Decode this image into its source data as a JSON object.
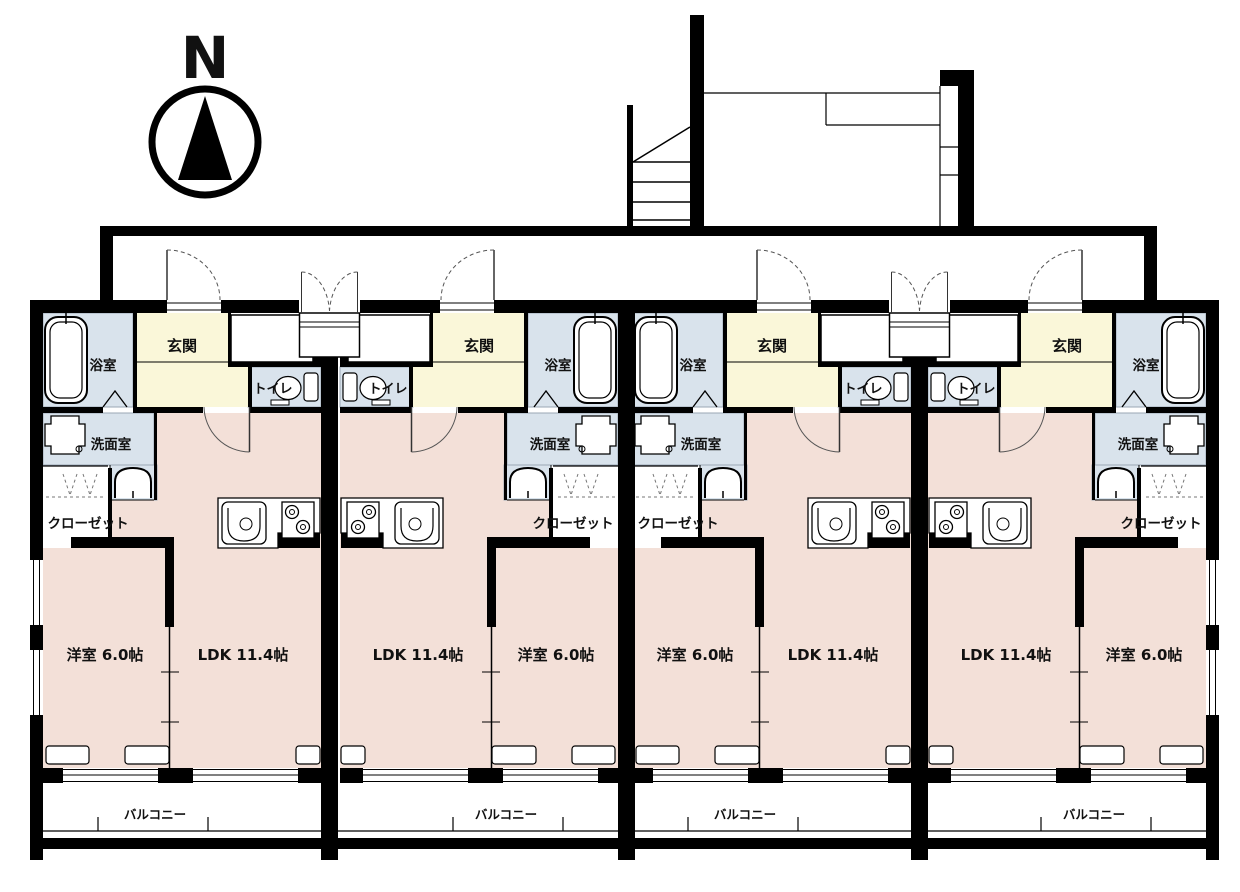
{
  "compass": {
    "label": "N"
  },
  "colors": {
    "wall": "#000000",
    "room_pink": "#f3e0d8",
    "entry_yellow": "#faf7d9",
    "wet_blue": "#d9e3ec",
    "floor_white": "#ffffff",
    "door_arc_gray": "#555555"
  },
  "units": [
    {
      "id": 1,
      "mirrored": false,
      "rooms": {
        "entrance": "玄関",
        "bathroom": "浴室",
        "toilet": "トイレ",
        "washroom": "洗面室",
        "closet": "クローゼット",
        "western_room": "洋室 6.0帖",
        "ldk": "LDK 11.4帖",
        "balcony": "バルコニー"
      }
    },
    {
      "id": 2,
      "mirrored": true,
      "rooms": {
        "entrance": "玄関",
        "bathroom": "浴室",
        "toilet": "トイレ",
        "washroom": "洗面室",
        "closet": "クローゼット",
        "western_room": "洋室 6.0帖",
        "ldk": "LDK 11.4帖",
        "balcony": "バルコニー"
      }
    },
    {
      "id": 3,
      "mirrored": false,
      "rooms": {
        "entrance": "玄関",
        "bathroom": "浴室",
        "toilet": "トイレ",
        "washroom": "洗面室",
        "closet": "クローゼット",
        "western_room": "洋室 6.0帖",
        "ldk": "LDK 11.4帖",
        "balcony": "バルコニー"
      }
    },
    {
      "id": 4,
      "mirrored": true,
      "rooms": {
        "entrance": "玄関",
        "bathroom": "浴室",
        "toilet": "トイレ",
        "washroom": "洗面室",
        "closet": "クローゼット",
        "western_room": "洋室 6.0帖",
        "ldk": "LDK 11.4帖",
        "balcony": "バルコニー"
      }
    }
  ]
}
